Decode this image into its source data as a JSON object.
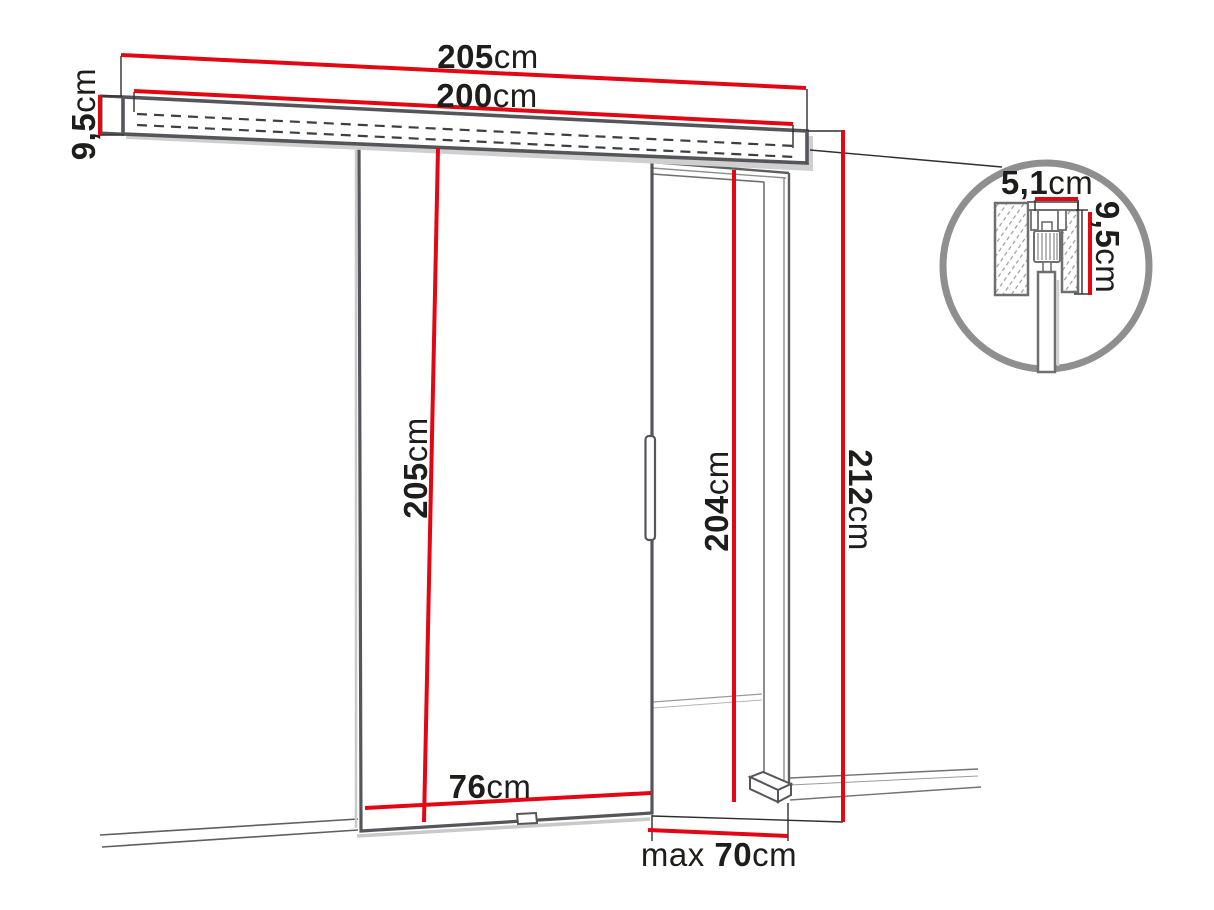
{
  "diagram": {
    "type": "sliding-door-technical-dimension-drawing",
    "colors": {
      "dimension_red": "#e30613",
      "outline_dark": "#55565a",
      "outline_mid": "#8f8f8f",
      "shadow_gray": "#cccccc",
      "text_black": "#1d1d1b",
      "detail_circle_stroke": "#8f8f8f"
    },
    "dims": {
      "rail_total_width": {
        "value": "205",
        "unit": "cm"
      },
      "rail_track_width": {
        "value": "200",
        "unit": "cm"
      },
      "rail_height": {
        "value": "9,5",
        "unit": "cm"
      },
      "door_height": {
        "value": "205",
        "unit": "cm"
      },
      "passage_height": {
        "value": "204",
        "unit": "cm"
      },
      "overall_height": {
        "value": "212",
        "unit": "cm"
      },
      "door_width": {
        "value": "76",
        "unit": "cm"
      },
      "max_opening_width": {
        "prefix": "max ",
        "value": "70",
        "unit": "cm"
      },
      "detail_track_depth": {
        "value": "5,1",
        "unit": "cm"
      },
      "detail_track_height": {
        "value": "9,5",
        "unit": "cm"
      }
    }
  }
}
